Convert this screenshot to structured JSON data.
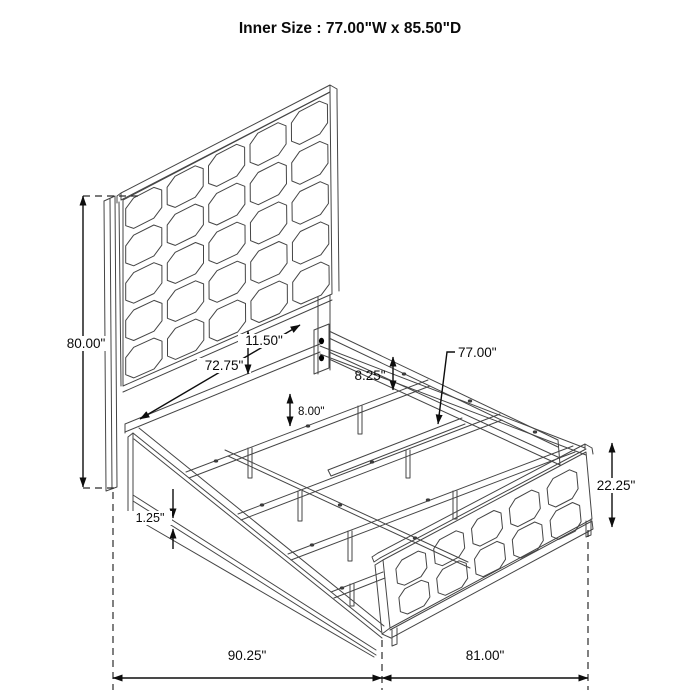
{
  "title": "Inner Size : 77.00\"W x 85.50\"D",
  "colors": {
    "background": "#ffffff",
    "artwork_line": "#454545",
    "dimension_line": "#0d0d0d",
    "text": "#0a0a0a"
  },
  "diagram": {
    "subject": "panel-bed-frame-isometric-line-drawing",
    "headboard_grid": "5x5 tufted squares",
    "footboard_grid": "5x2 tufted squares"
  },
  "annotations": {
    "headboard_height": "80.00\"",
    "inner_slat_width": "72.75\"",
    "headboard_panel_gap": "11.50\"",
    "support_rail_height": "8.25\"",
    "leg_height": "8.00\"",
    "inner_width": "77.00\"",
    "footboard_height": "22.25\"",
    "rail_trim_gap": "1.25\"",
    "overall_length": "90.25\"",
    "overall_width": "81.00\""
  }
}
